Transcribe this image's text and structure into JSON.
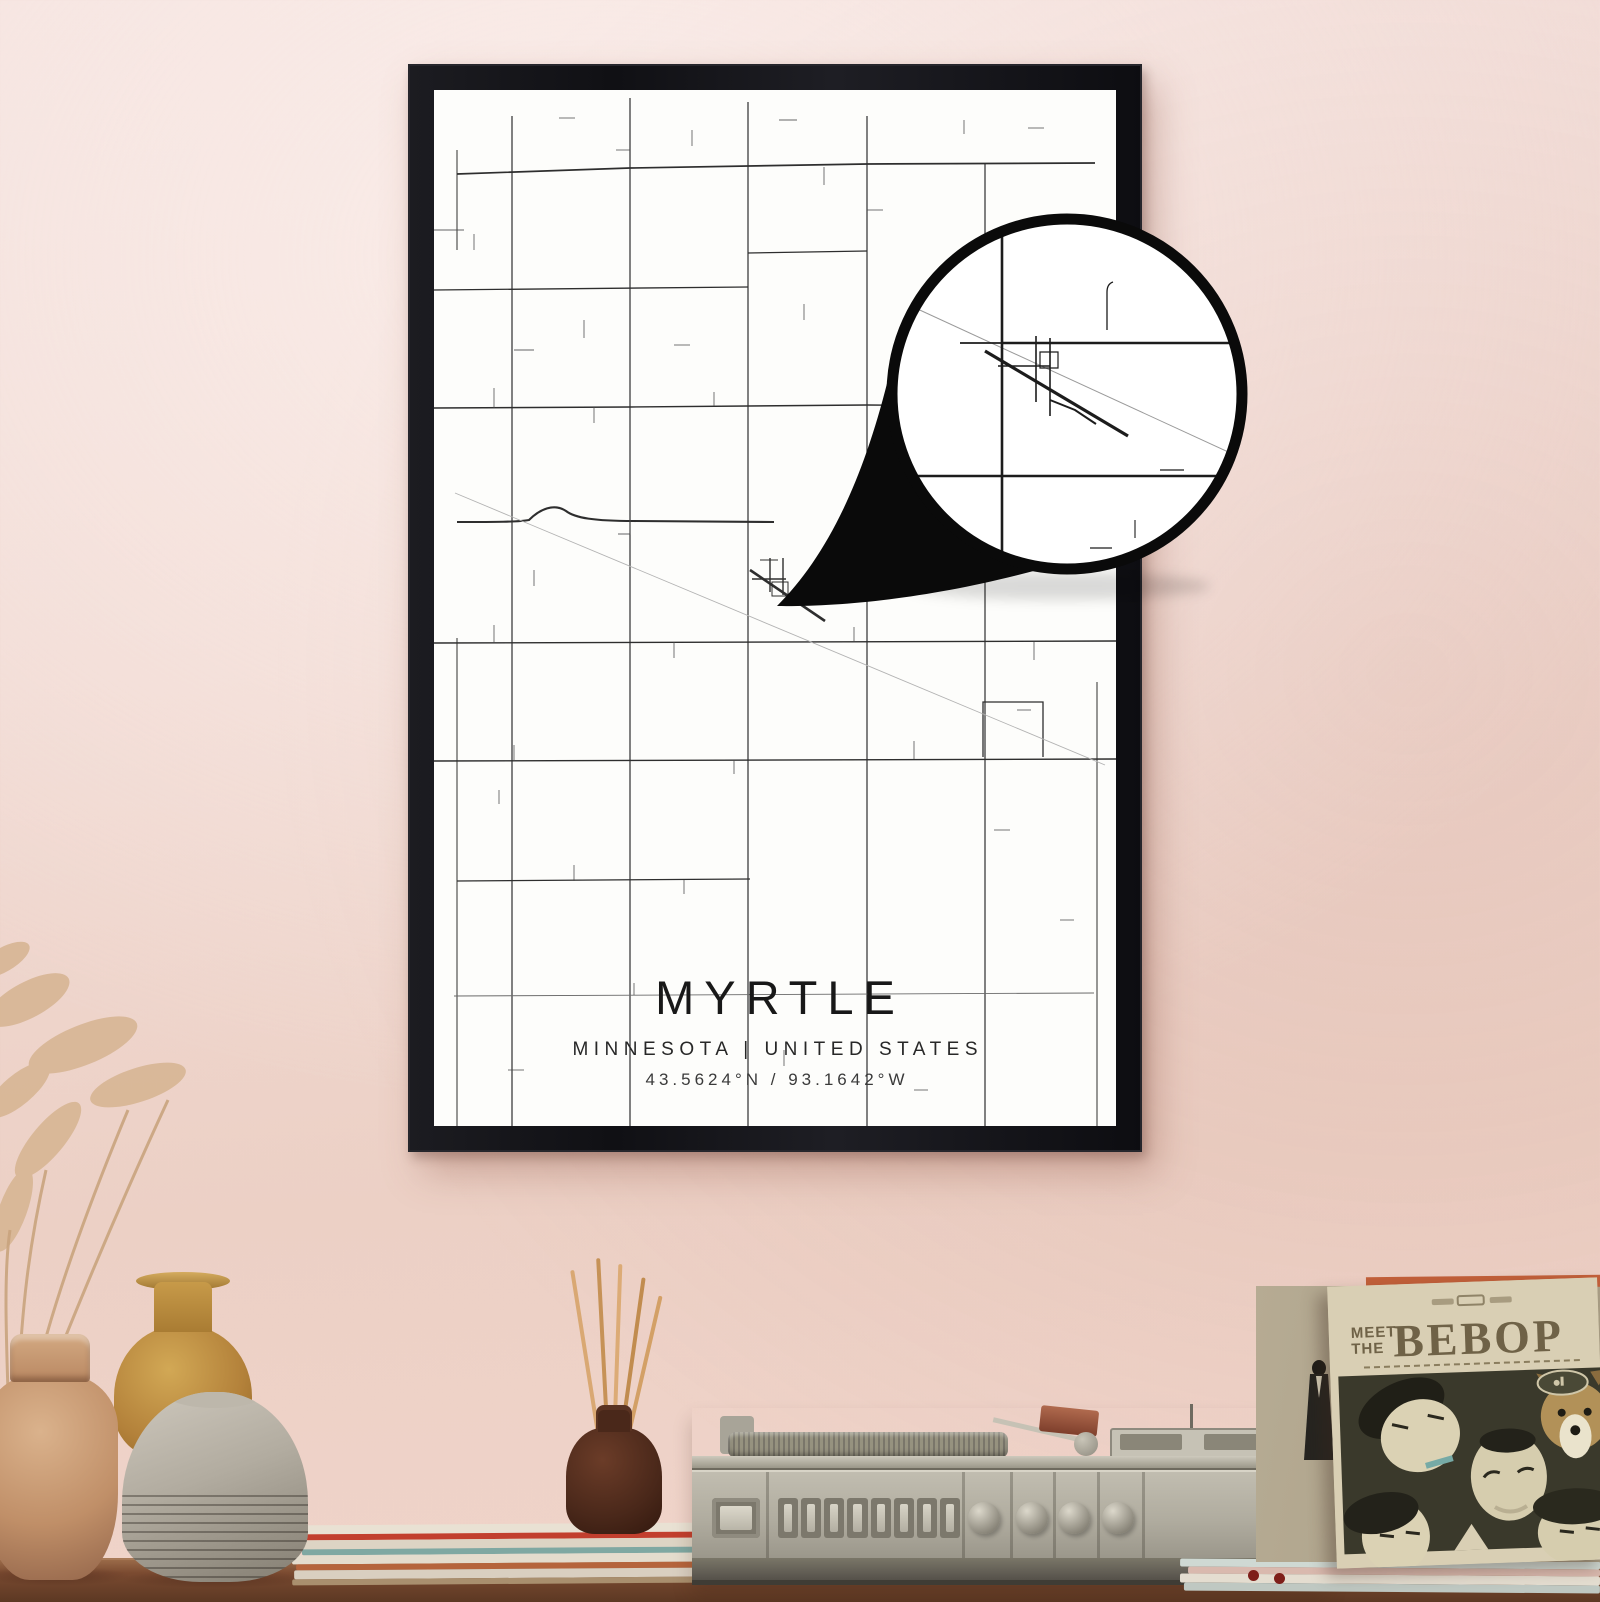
{
  "poster": {
    "title": "MYRTLE",
    "subtitle": "MINNESOTA | UNITED STATES",
    "coordinates": "43.5624°N / 93.1642°W"
  },
  "record_sleeve": {
    "word_meet": "MEET",
    "word_the": "THE",
    "word_title": "BEBOP"
  },
  "colors": {
    "wall_top": "#f4e1dd",
    "wall_bottom": "#f0d4ca",
    "frame": "#15151a",
    "poster_background": "#fdfdfb",
    "map_road": "#2e2e2e",
    "railroad": "#b3b3b3",
    "magnifier_ring": "#0a0a0a",
    "wood_shelf": "#7b4b31",
    "sleeve_background": "#d9cfb4",
    "sleeve_text": "#6f6247",
    "sleeve_photo_background": "#3a392b"
  }
}
